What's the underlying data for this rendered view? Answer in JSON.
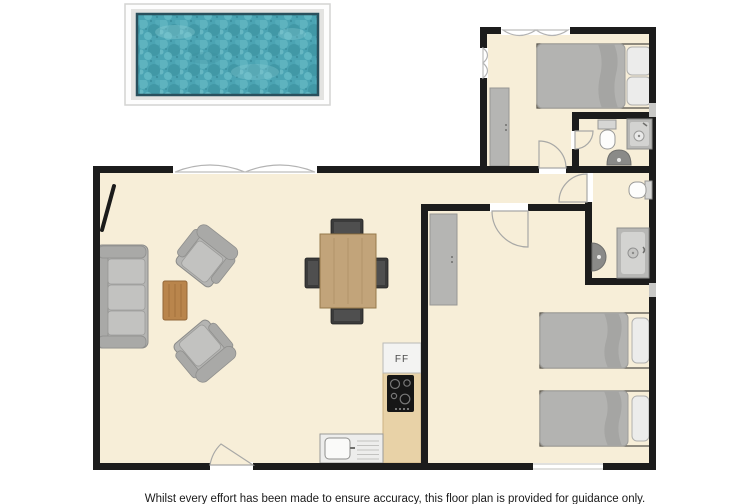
{
  "disclaimer": "Whilst every effort has been made to ensure accuracy, this floor plan is provided for guidance only.",
  "labels": {
    "fridge_freezer": "FF"
  },
  "colors": {
    "background": "#ffffff",
    "floor": "#f7eed8",
    "wall": "#1c1c1c",
    "pool_water": "#4ba4b3",
    "pool_water_border": "#29505d",
    "pool_deck": "#e3e3e1",
    "sofa_gray": "#b4b4b2",
    "bed_gray": "#b3b3b1",
    "pillow_white": "#ececeb",
    "coffee_table_wood": "#b9854c",
    "dining_table_wood": "#c2a47a",
    "kitchen_counter_wood": "#e8d2a7",
    "hob_black": "#161616",
    "fixture_gray": "#8a8a88"
  }
}
